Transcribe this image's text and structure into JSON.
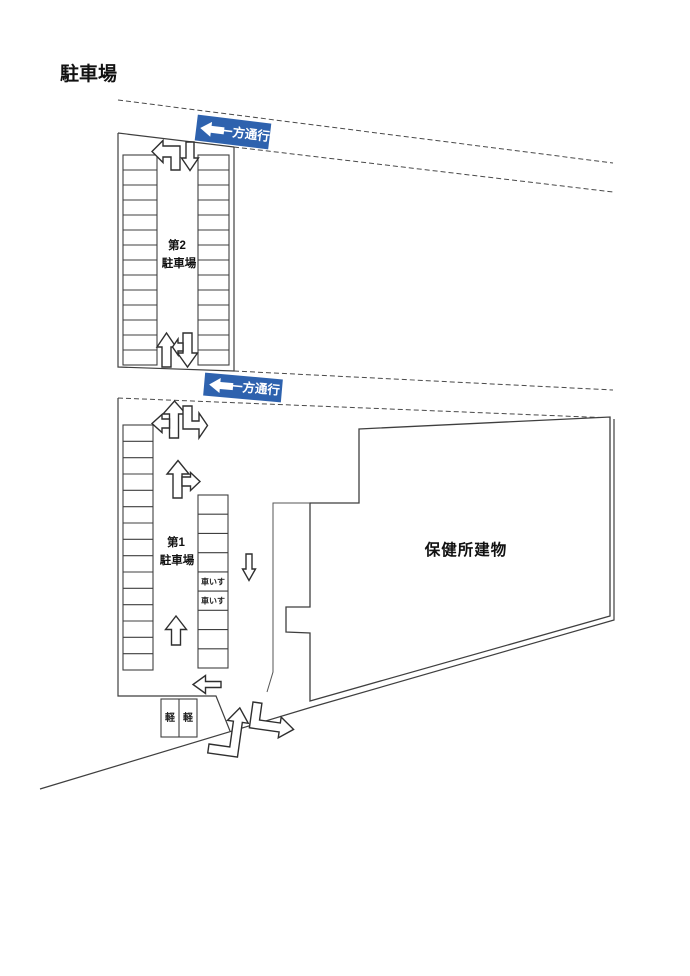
{
  "page": {
    "title": "駐車場"
  },
  "road": {
    "one_way_sign_top": {
      "label": "一方通行",
      "arrow_direction": "left"
    },
    "one_way_sign_middle": {
      "label": "一方通行",
      "arrow_direction": "left"
    }
  },
  "lot2": {
    "name_line1": "第2",
    "name_line2": "駐車場",
    "left_column_stalls": 14,
    "right_column_stalls": 14
  },
  "lot1": {
    "name_line1": "第1",
    "name_line2": "駐車場",
    "left_column_stalls": 15,
    "middle_column_stalls": 9,
    "wheelchair_stall_label": "車いす",
    "wheelchair_stall_rows": [
      5,
      6
    ],
    "kei_stall_label": "軽",
    "kei_stall_count": 2
  },
  "building": {
    "label": "保健所建物"
  },
  "colors": {
    "sign_blue": "#2e62ae",
    "line": "#3f3f3f",
    "background": "#ffffff"
  }
}
